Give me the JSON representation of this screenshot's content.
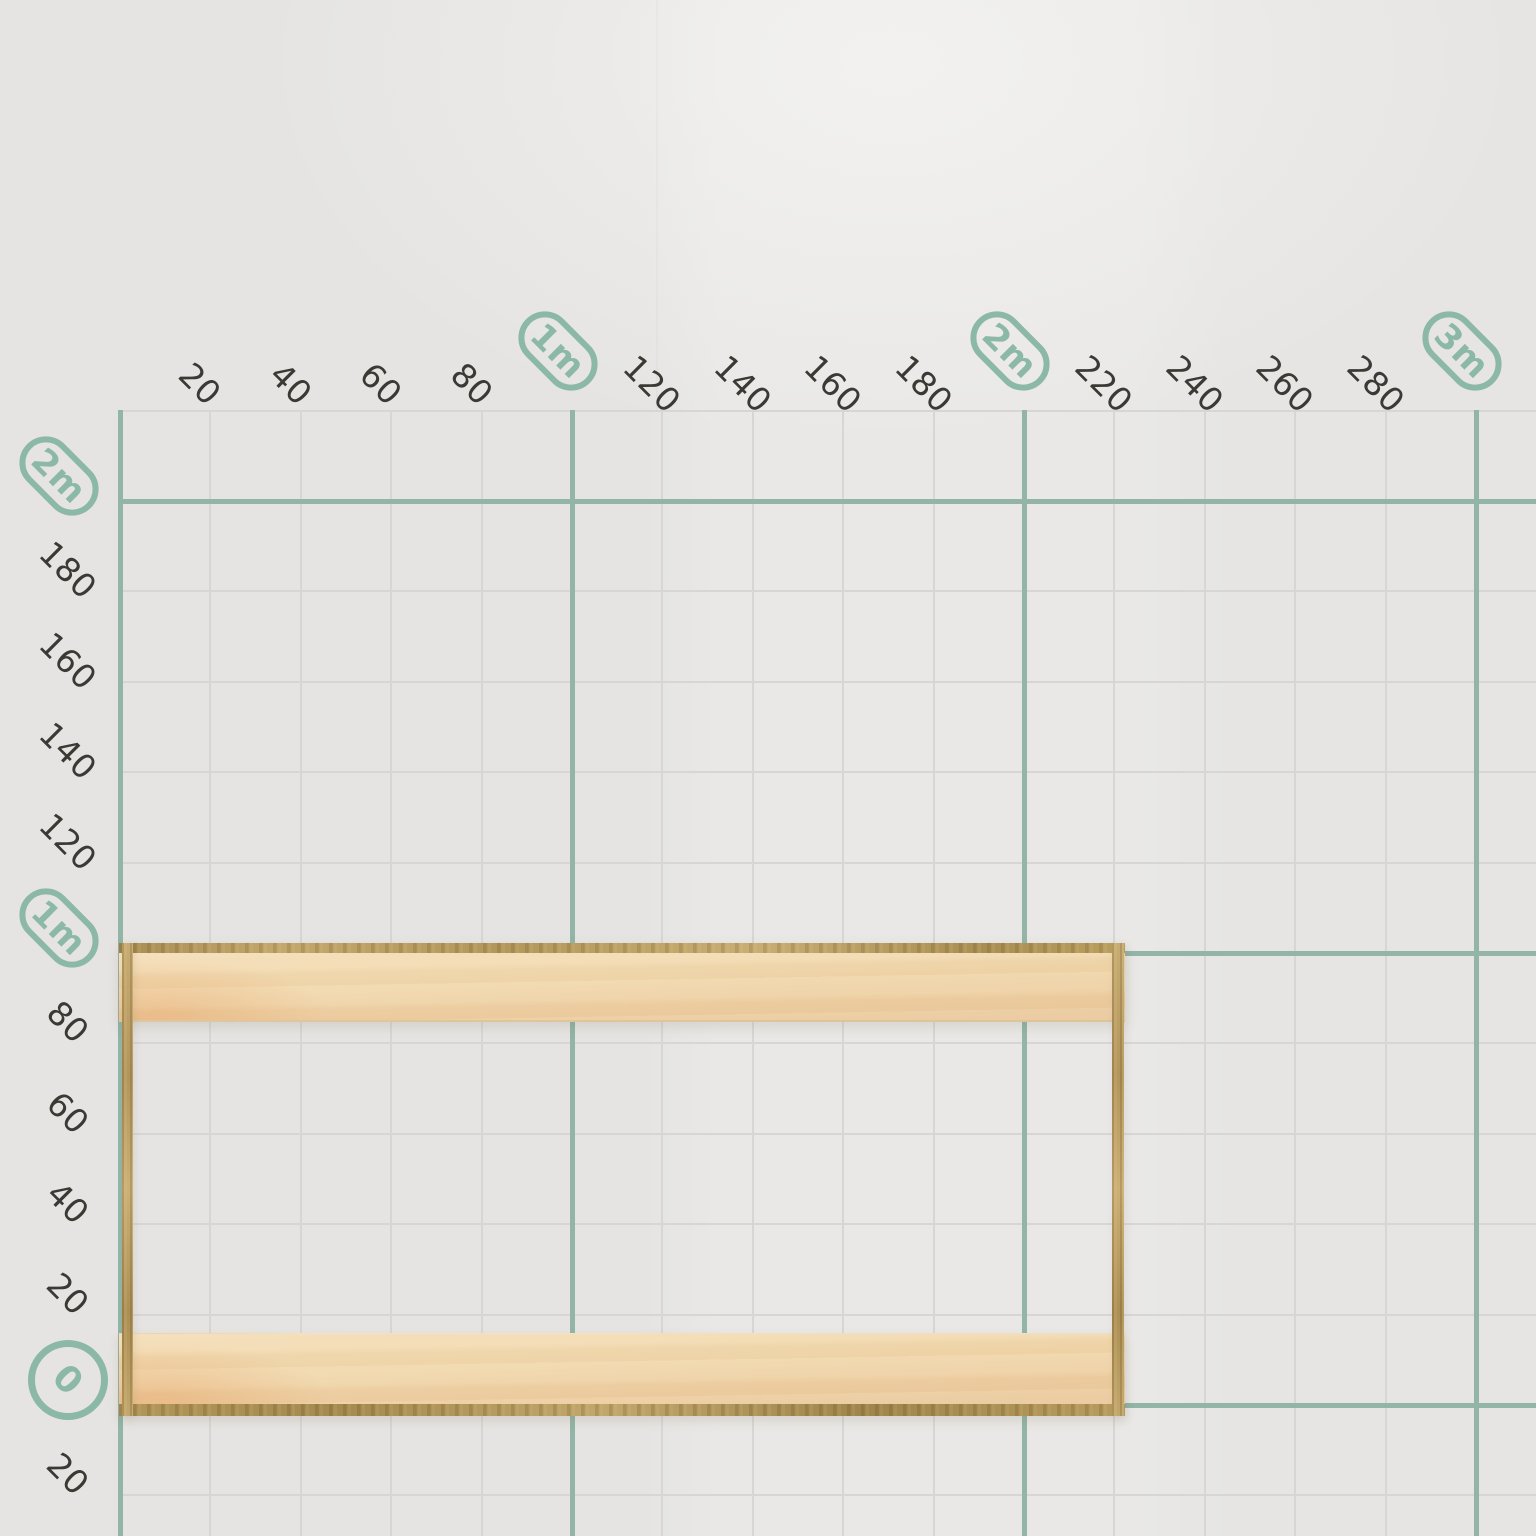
{
  "scene": {
    "width": 1536,
    "height": 1536,
    "description": "Build-mode wall grid with centimeter rulers and a plywood frame placed on the floor line"
  },
  "colors": {
    "background": "#e8e7e5",
    "grid_minor": "#d8d6d4",
    "grid_major": "#92b5a7",
    "badge": "#8cb8a8",
    "tick_text": "#3c3935",
    "wood_face": "#f1d7a9",
    "wood_edge": "#b89c5f",
    "wood_edge_dark": "#a48a4e"
  },
  "grid": {
    "unit": "cm",
    "minor_step_cm": 20,
    "major_step_cm": 100,
    "x_min_cm": 0,
    "x_max_cm": 300,
    "y_min_cm": -20,
    "y_max_cm": 220,
    "top_axis": [
      {
        "label": "20",
        "cm": 20,
        "kind": "number"
      },
      {
        "label": "40",
        "cm": 40,
        "kind": "number"
      },
      {
        "label": "60",
        "cm": 60,
        "kind": "number"
      },
      {
        "label": "80",
        "cm": 80,
        "kind": "number"
      },
      {
        "label": "1m",
        "cm": 100,
        "kind": "pill"
      },
      {
        "label": "120",
        "cm": 120,
        "kind": "number"
      },
      {
        "label": "140",
        "cm": 140,
        "kind": "number"
      },
      {
        "label": "160",
        "cm": 160,
        "kind": "number"
      },
      {
        "label": "180",
        "cm": 180,
        "kind": "number"
      },
      {
        "label": "2m",
        "cm": 200,
        "kind": "pill"
      },
      {
        "label": "220",
        "cm": 220,
        "kind": "number"
      },
      {
        "label": "240",
        "cm": 240,
        "kind": "number"
      },
      {
        "label": "260",
        "cm": 260,
        "kind": "number"
      },
      {
        "label": "280",
        "cm": 280,
        "kind": "number"
      },
      {
        "label": "3m",
        "cm": 300,
        "kind": "pill"
      }
    ],
    "left_axis": [
      {
        "label": "2m",
        "cm": 200,
        "kind": "pill"
      },
      {
        "label": "180",
        "cm": 180,
        "kind": "number"
      },
      {
        "label": "160",
        "cm": 160,
        "kind": "number"
      },
      {
        "label": "140",
        "cm": 140,
        "kind": "number"
      },
      {
        "label": "120",
        "cm": 120,
        "kind": "number"
      },
      {
        "label": "1m",
        "cm": 100,
        "kind": "pill"
      },
      {
        "label": "80",
        "cm": 80,
        "kind": "number"
      },
      {
        "label": "60",
        "cm": 60,
        "kind": "number"
      },
      {
        "label": "40",
        "cm": 40,
        "kind": "number"
      },
      {
        "label": "20",
        "cm": 20,
        "kind": "number"
      },
      {
        "label": "0",
        "cm": 0,
        "kind": "circle"
      },
      {
        "label": "20",
        "cm": -20,
        "kind": "number"
      }
    ]
  },
  "wood_frame": {
    "material": "plywood",
    "spans_x_cm": [
      0,
      220
    ],
    "spans_y_cm": [
      0,
      102
    ],
    "parts": [
      "top-plank",
      "bottom-plank",
      "left-panel",
      "right-panel"
    ]
  }
}
